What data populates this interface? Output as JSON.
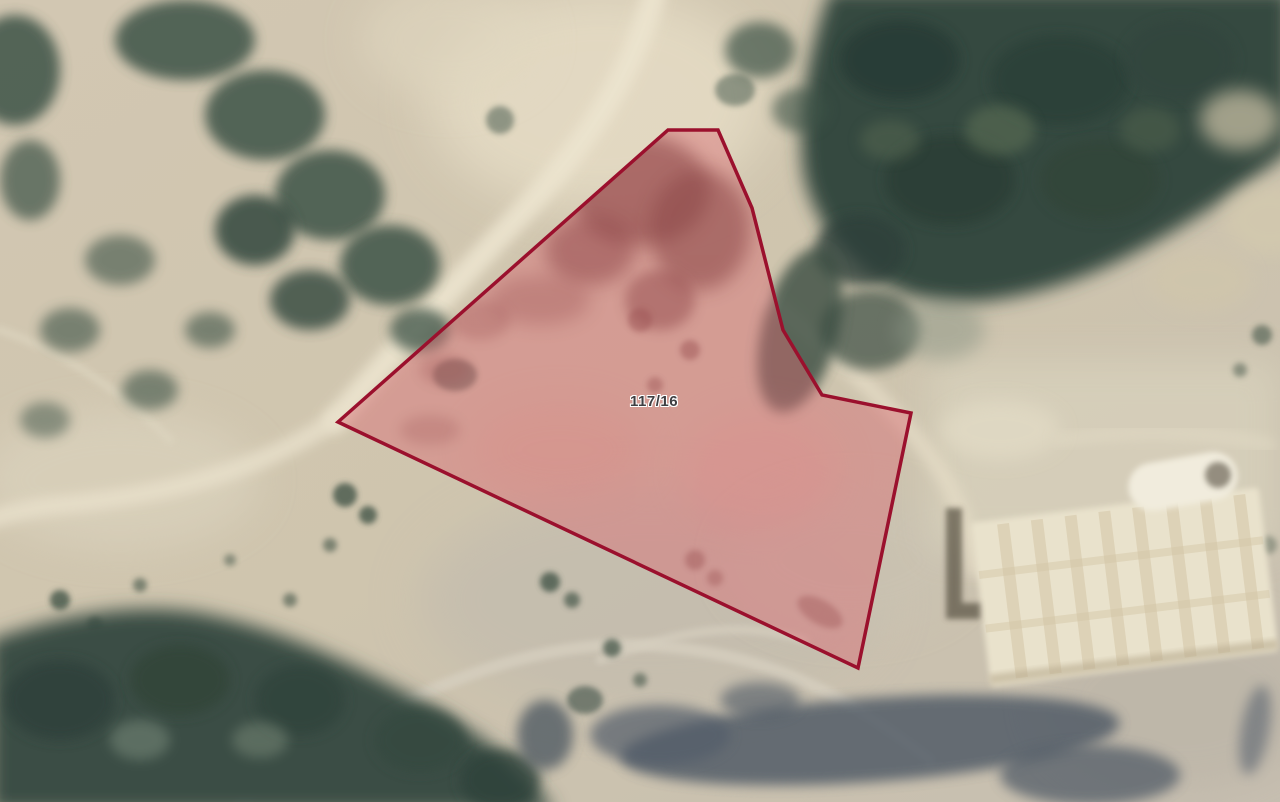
{
  "map": {
    "view": "satellite",
    "parcel": {
      "id": "117/16",
      "points": "668,130 718,130 752,208 783,330 822,395 911,413 858,668 338,422",
      "outline_color": "#9b102d",
      "fill_color": "#d96a74",
      "fill_opacity": "0.45"
    },
    "palette": {
      "terrain_base": "#cdc2ad",
      "forest_dark": "#354840",
      "road_light": "#ece4cf",
      "shadow_band": "#4b5664",
      "structure_cream": "#e9e2cc",
      "parcel_inner_brush": "#53302b"
    }
  }
}
